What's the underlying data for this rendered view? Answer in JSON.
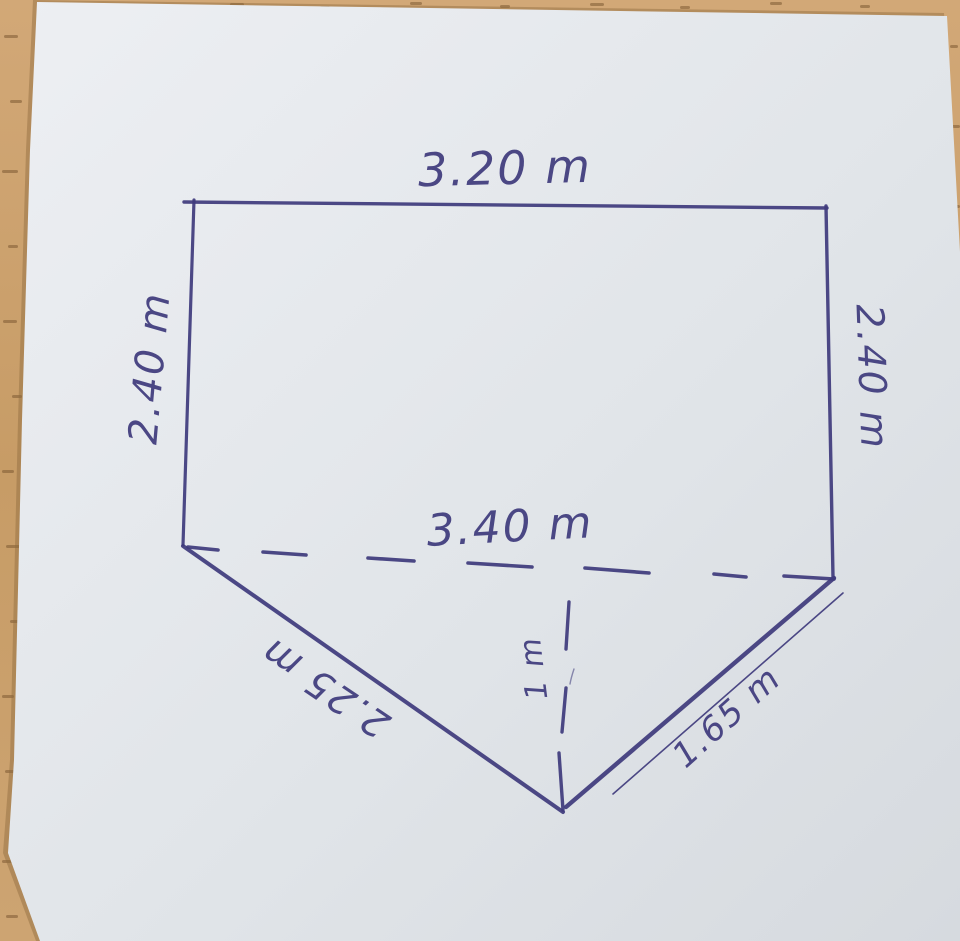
{
  "scene": {
    "description": "Photo of a hand-drawn geometry sketch in blue ink on a pale note sheet lying on a wooden desk",
    "ink_color": "#3e3a7c",
    "paper_color": "#e2e6ea",
    "wood_color": "#c9a06b"
  },
  "figure": {
    "shape": "pentagon: rectangle on top, triangle below a dashed interior line",
    "labels": {
      "top_width": "3.20 m",
      "left_height": "2.40 m",
      "right_height": "2.40 m",
      "middle_width": "3.40 m",
      "left_slant": "2.25 m",
      "right_slant": "1.65 m",
      "triangle_height": "1 m"
    }
  }
}
